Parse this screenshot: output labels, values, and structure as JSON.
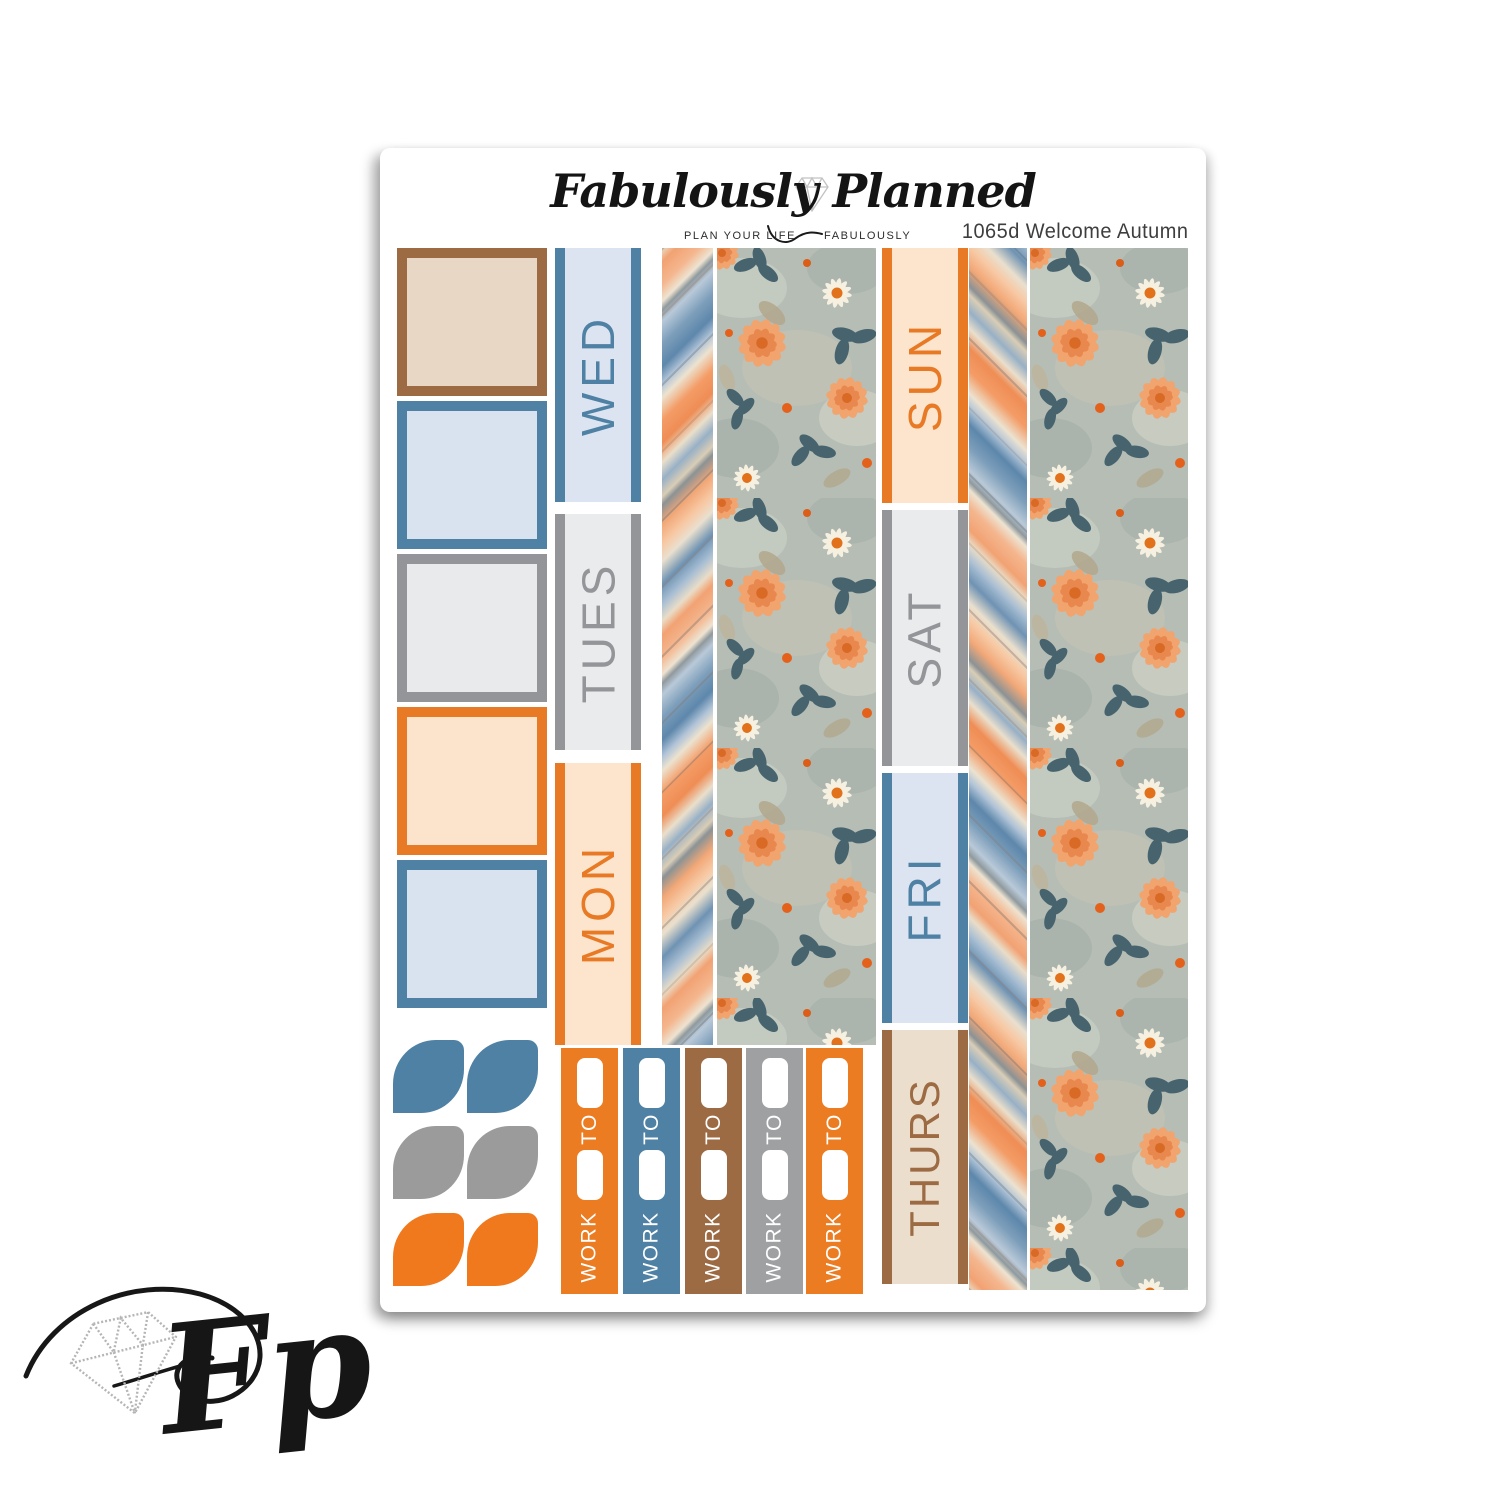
{
  "header": {
    "brand_script": "Fabulously Planned",
    "tagline_left": "PLAN YOUR LIFE",
    "tagline_right": "FABULOUSLY",
    "product_code": "1065d Welcome Autumn"
  },
  "palette": {
    "orange": "#E87A25",
    "peach": "#FCE4CC",
    "blue": "#4E81A4",
    "light_blue": "#DAE3F0",
    "gray": "#939598",
    "light_gray": "#E9EAEB",
    "brown": "#9C6A43",
    "tan": "#E9D8C7",
    "thurs_cream": "#ECDECD"
  },
  "boxes": [
    {
      "border": "#9C6A43",
      "fill": "#E8D7C5"
    },
    {
      "border": "#4E81A4",
      "fill": "#D9E2EF"
    },
    {
      "border": "#939598",
      "fill": "#E9EAEB"
    },
    {
      "border": "#E87A25",
      "fill": "#FCE3CB"
    },
    {
      "border": "#4E81A4",
      "fill": "#D9E2EF"
    }
  ],
  "left_day_flags": [
    {
      "label": "WED",
      "edge": "#4E81A4",
      "fill": "#DCE4F1"
    },
    {
      "label": "TUES",
      "edge": "#939598",
      "fill": "#EAEBEC"
    },
    {
      "label": "MON",
      "edge": "#E87A25",
      "fill": "#FCE4CD"
    }
  ],
  "right_day_flags": [
    {
      "label": "SUN",
      "edge": "#E87A25",
      "fill": "#FCE4CD"
    },
    {
      "label": "SAT",
      "edge": "#939598",
      "fill": "#EAEBEC"
    },
    {
      "label": "FRI",
      "edge": "#4E81A4",
      "fill": "#DCE4F1"
    },
    {
      "label": "THURS",
      "edge": "#9C6A43",
      "fill": "#ECDECD"
    }
  ],
  "petal_rows": [
    {
      "color": "#4E81A4"
    },
    {
      "color": "#9B9B9B"
    },
    {
      "color": "#F0791E"
    }
  ],
  "work_banner": {
    "work_label": "WORK",
    "to_label": "TO",
    "strips": [
      {
        "color": "#EB7C22"
      },
      {
        "color": "#4E81A4"
      },
      {
        "color": "#9C6A43"
      },
      {
        "color": "#9EA0A2"
      },
      {
        "color": "#EB7C22"
      }
    ]
  },
  "washi": {
    "striped_left_direction": "diagonal stripes rising left-to-right",
    "striped_right_direction": "diagonal stripes falling left-to-right",
    "stripe_colors": [
      "#F2A273",
      "#ECE2D0",
      "#7E9FBB",
      "#5D87AB",
      "#B9C9D8",
      "#8B9295",
      "#E9DDC9",
      "#F49C66"
    ],
    "floral": {
      "background": "#B5BDB5",
      "flower_peach": "#F2A46F",
      "flower_deep": "#E8854A",
      "daisy_white": "#F6F0E1",
      "flower_center": "#E2711C",
      "leaf_dark": "#46636E",
      "leaf_beige": "#B2A78C",
      "bud_orange": "#E4611B"
    }
  },
  "watermark": {
    "monogram": "Fp"
  },
  "icons": {
    "header_diamond": "gem-outline",
    "watermark_diamond": "gem-outline-sparkle"
  }
}
